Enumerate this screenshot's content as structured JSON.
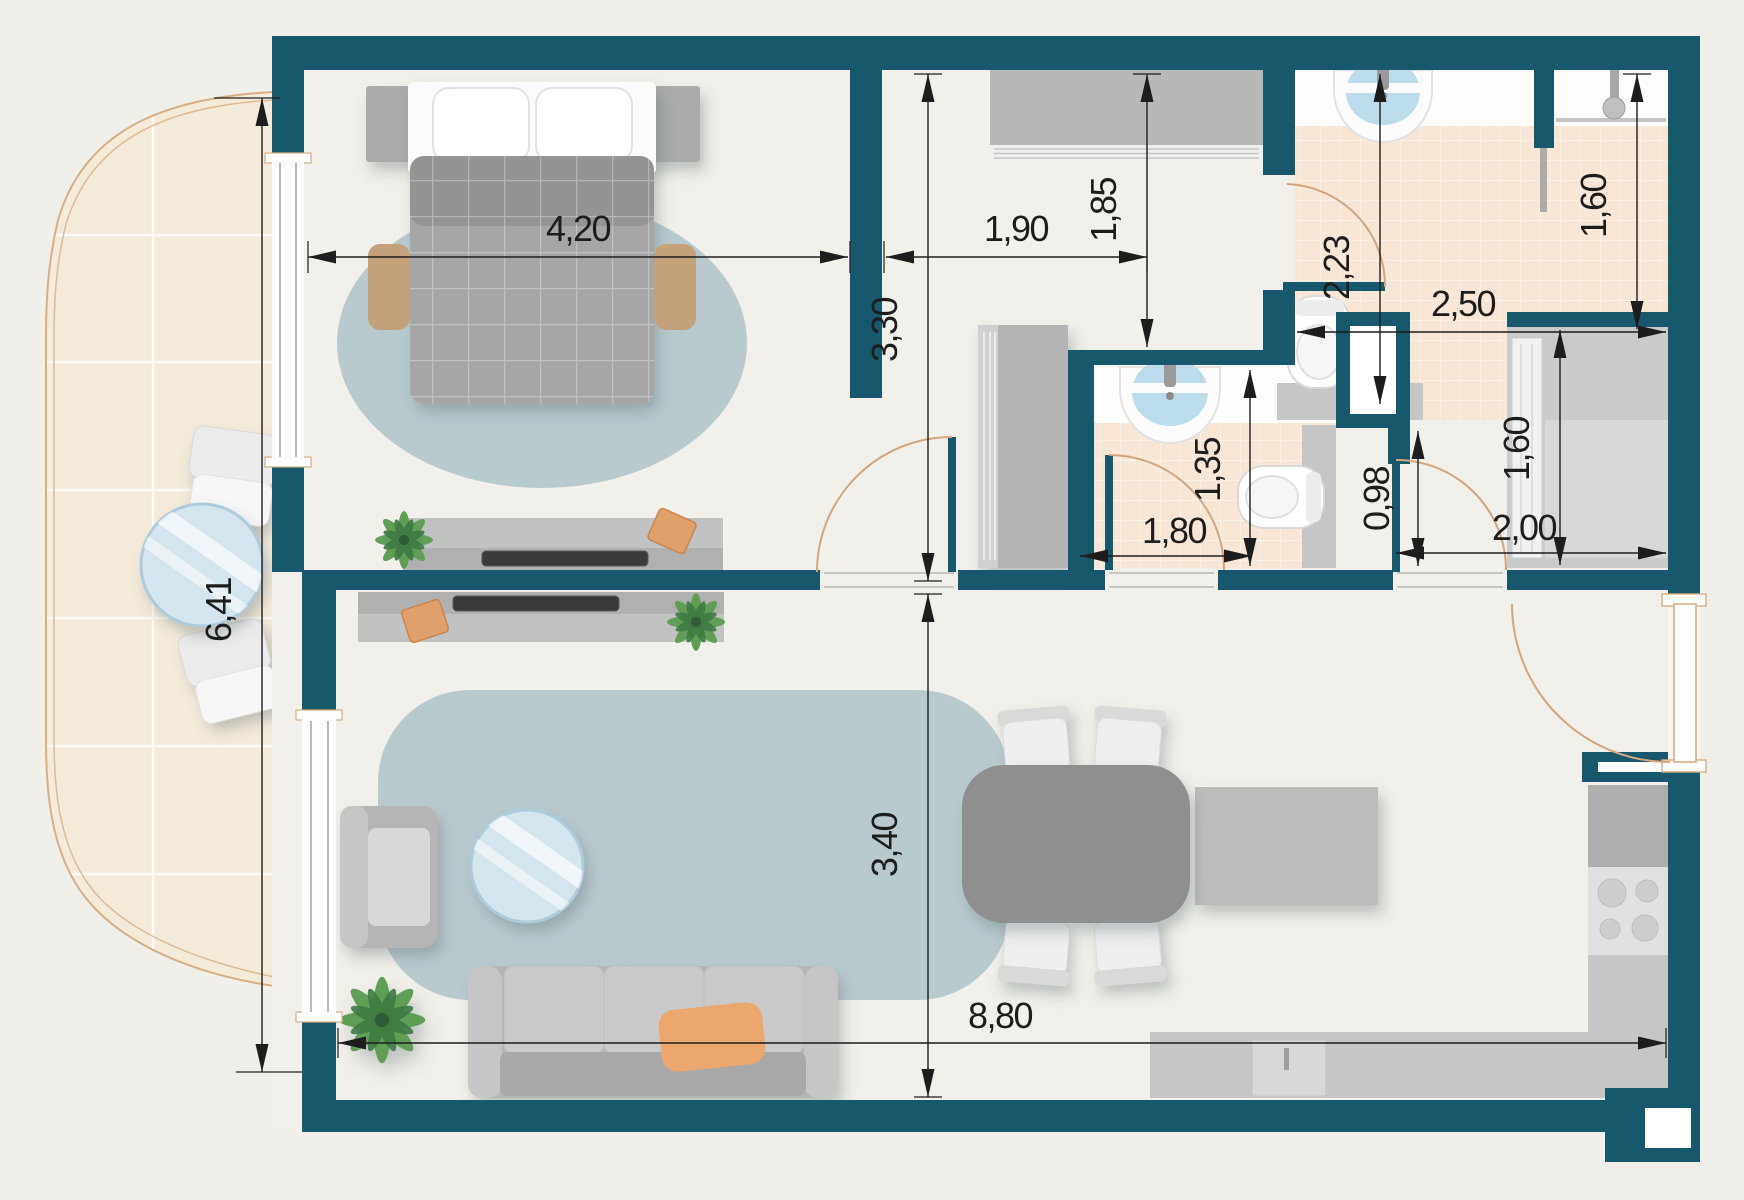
{
  "plan": {
    "type": "apartment-floor-plan",
    "dimensions": [
      {
        "id": "bedroom-width",
        "value": "4,20"
      },
      {
        "id": "hall-width",
        "value": "1,90"
      },
      {
        "id": "hall-depth",
        "value": "1,85"
      },
      {
        "id": "bedroom-depth",
        "value": "3,30"
      },
      {
        "id": "bathroom-depth",
        "value": "2,23"
      },
      {
        "id": "bathroom-width",
        "value": "2,50"
      },
      {
        "id": "shower-depth",
        "value": "1,60"
      },
      {
        "id": "wc-depth",
        "value": "1,35"
      },
      {
        "id": "wc-width",
        "value": "1,80"
      },
      {
        "id": "corridor-depth",
        "value": "0,98"
      },
      {
        "id": "corridor-width",
        "value": "2,00"
      },
      {
        "id": "closet-depth",
        "value": "1,60"
      },
      {
        "id": "living-depth",
        "value": "3,40"
      },
      {
        "id": "apartment-width",
        "value": "8,80"
      },
      {
        "id": "balcony-length",
        "value": "6,41"
      }
    ],
    "colors": {
      "wall": "#17586c",
      "interior_floor": "#f1f0ea",
      "balcony_floor": "#f5ebdb",
      "tile_floor": "#f8e7d6",
      "rug": "#b9cacf",
      "door_swing": "#d4a57d",
      "glass": "#d4e5ee",
      "sofa_pillow": "#eba76e",
      "dimension_ink": "#1d1d1d"
    }
  }
}
